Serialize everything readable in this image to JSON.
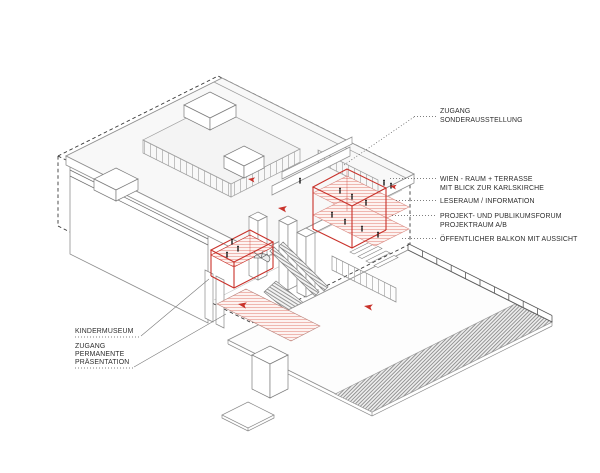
{
  "annotations": {
    "right": [
      {
        "id": "zugang-sonderausstellung",
        "line1": "ZUGANG",
        "line2": "SONDERAUSSTELLUNG"
      },
      {
        "id": "wien-raum-terrasse",
        "line1": "WIEN - RAUM + TERRASSE",
        "line2": "MIT BLICK ZUR KARLSKIRCHE"
      },
      {
        "id": "leseraum",
        "line1": "LESERAUM / INFORMATION"
      },
      {
        "id": "projektforum",
        "line1": "PROJEKT- UND PUBLIKUMSFORUM",
        "line2": "PROJEKTRAUM A/B"
      },
      {
        "id": "balkon",
        "line1": "ÖFFENTLICHER BALKON MIT AUSSICHT"
      }
    ],
    "left": [
      {
        "id": "kindermuseum",
        "line1": "KINDERMUSEUM"
      },
      {
        "id": "zugang-permanente",
        "line1": "ZUGANG",
        "line2": "PERMANENTE",
        "line3": "PRÄSENTATION"
      }
    ]
  },
  "icons": {
    "entrance_arrow": "entrance-direction-arrow",
    "people_figure": "scale-figure"
  },
  "colors": {
    "accent_red": "#c9322b",
    "hatch_pink": "#eca89f",
    "hatch_gray": "#8d8d8d",
    "line_gray": "#8f8f8f",
    "dash_black": "#2f2f2f",
    "label_text": "#2c2c2c"
  }
}
